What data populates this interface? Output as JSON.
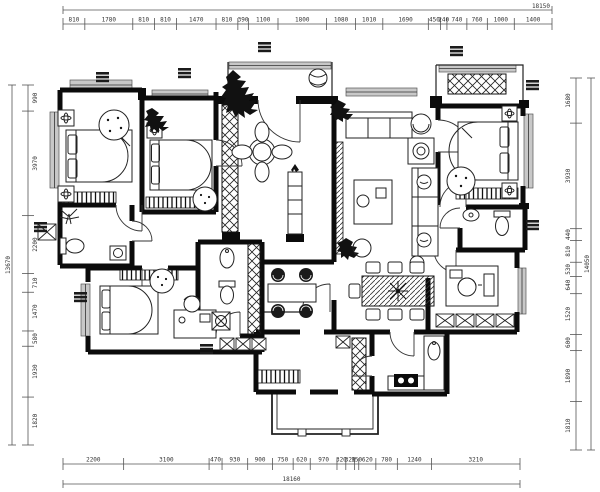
{
  "drawing": {
    "type": "apartment-floor-plan",
    "colors": {
      "ink": "#0b0b0b",
      "dim_line": "#555555",
      "dim_text": "#333333",
      "window_sill": "#c8c8c8"
    },
    "dimensions": {
      "top": {
        "total": "18150",
        "segments": [
          "810",
          "1780",
          "810",
          "810",
          "1470",
          "810",
          "390",
          "1100",
          "1800",
          "1080",
          "1010",
          "1690",
          "450",
          "240",
          "740",
          "760",
          "1000",
          "1400"
        ]
      },
      "bottom": {
        "total": "18160",
        "segments": [
          "2200",
          "3100",
          "470",
          "930",
          "900",
          "750",
          "620",
          "970",
          "320",
          "320",
          "150",
          "620",
          "780",
          "1240",
          "3210"
        ]
      },
      "left": {
        "total": "13670",
        "segments": [
          "990",
          "3970",
          "2200",
          "710",
          "1470",
          "580",
          "1930",
          "1820"
        ]
      },
      "right": {
        "total": "14050",
        "segments": [
          "1680",
          "3930",
          "440",
          "810",
          "530",
          "640",
          "1520",
          "600",
          "1890",
          "1810"
        ]
      }
    }
  }
}
